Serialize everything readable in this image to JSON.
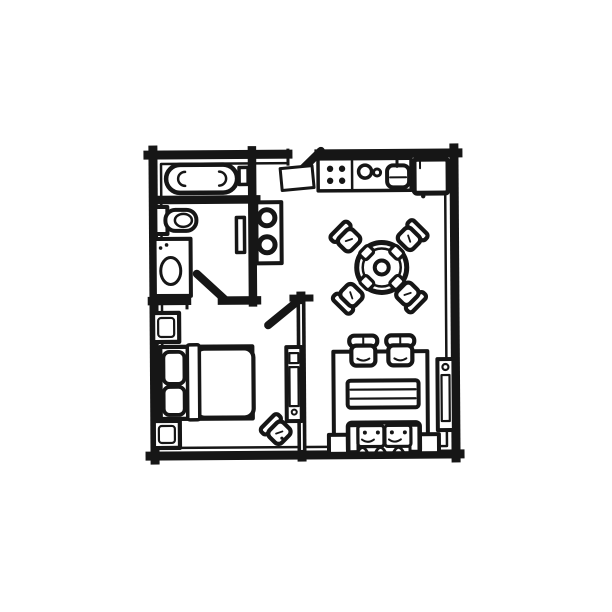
{
  "style": {
    "ink": "#161616",
    "paper": "#ffffff",
    "canvas_background": "#ffffff"
  },
  "canvas": {
    "width": 612,
    "height": 612
  },
  "plan": {
    "kind": "hand-drawn-floor-plan",
    "rooms": [
      {
        "id": "bathroom",
        "items": [
          "bathtub",
          "tub-shelf",
          "toilet",
          "vanity-sink",
          "towel-rail"
        ]
      },
      {
        "id": "hallway",
        "items": [
          "washer-panel",
          "doormat"
        ]
      },
      {
        "id": "kitchen",
        "items": [
          "stove-four-burners",
          "counter-circles",
          "kitchen-sink",
          "refrigerator"
        ]
      },
      {
        "id": "dining-area",
        "items": [
          "round-table",
          "center-plate",
          "plate",
          "plate",
          "plate",
          "plate",
          "chair",
          "chair",
          "chair",
          "chair"
        ]
      },
      {
        "id": "living-area",
        "items": [
          "rug",
          "armchair",
          "armchair",
          "coffee-table",
          "sofa",
          "side-table",
          "side-table",
          "media-sideboard"
        ]
      },
      {
        "id": "bedroom",
        "items": [
          "double-bed",
          "pillow",
          "pillow",
          "blanket",
          "nightstand",
          "nightstand",
          "wardrobe-sideboard",
          "corner-chair"
        ]
      }
    ],
    "doors": [
      {
        "id": "entry-door",
        "location": "top-wall",
        "state": "open"
      },
      {
        "id": "bathroom-door",
        "location": "bathroom-bedroom-wall",
        "state": "open"
      },
      {
        "id": "bedroom-door",
        "location": "hall-to-bedroom",
        "state": "open"
      }
    ]
  }
}
